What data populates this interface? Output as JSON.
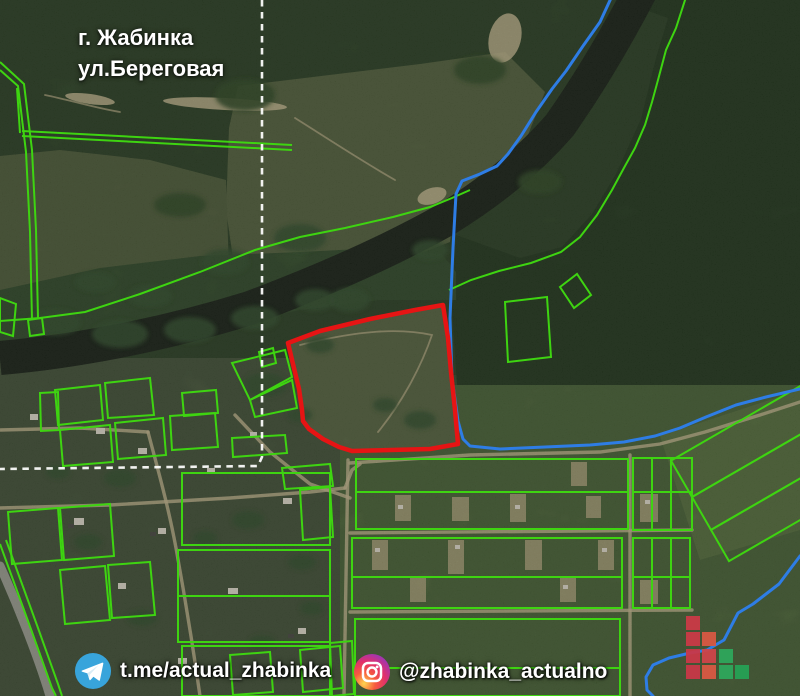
{
  "header": {
    "city_line": "г. Жабинка",
    "street_line": "ул.Береговая"
  },
  "footer": {
    "telegram": {
      "icon": "telegram-icon",
      "handle": "t.me/actual_zhabinka",
      "icon_color": "#38a4db"
    },
    "instagram": {
      "icon": "instagram-icon",
      "handle": "@zhabinka_actualno",
      "icon_gradient": [
        "#fdd54f",
        "#f75c3c",
        "#e1306c",
        "#9b36b7",
        "#6a3ab2"
      ]
    }
  },
  "map": {
    "overlay_colors": {
      "highlight_red": "#e61414",
      "cadastral_green": "#3ed411",
      "water_blue": "#2e7de5",
      "dash_white": "#ffffff"
    }
  },
  "logo": {
    "name": "pixel-squares-logo",
    "cell": 14,
    "step": 16.4,
    "origin": {
      "x": 686,
      "y": 616
    },
    "squares": [
      {
        "row": 0,
        "col": 0,
        "color": "#cb3a47"
      },
      {
        "row": 1,
        "col": 0,
        "color": "#cb3a47"
      },
      {
        "row": 1,
        "col": 1,
        "color": "#d95843"
      },
      {
        "row": 2,
        "col": 0,
        "color": "#c93848"
      },
      {
        "row": 2,
        "col": 1,
        "color": "#d0444a"
      },
      {
        "row": 2,
        "col": 2,
        "color": "#2fa65c"
      },
      {
        "row": 3,
        "col": 0,
        "color": "#c93848"
      },
      {
        "row": 3,
        "col": 1,
        "color": "#d95843"
      },
      {
        "row": 3,
        "col": 2,
        "color": "#2fa65c"
      },
      {
        "row": 3,
        "col": 3,
        "color": "#27a155"
      }
    ]
  }
}
